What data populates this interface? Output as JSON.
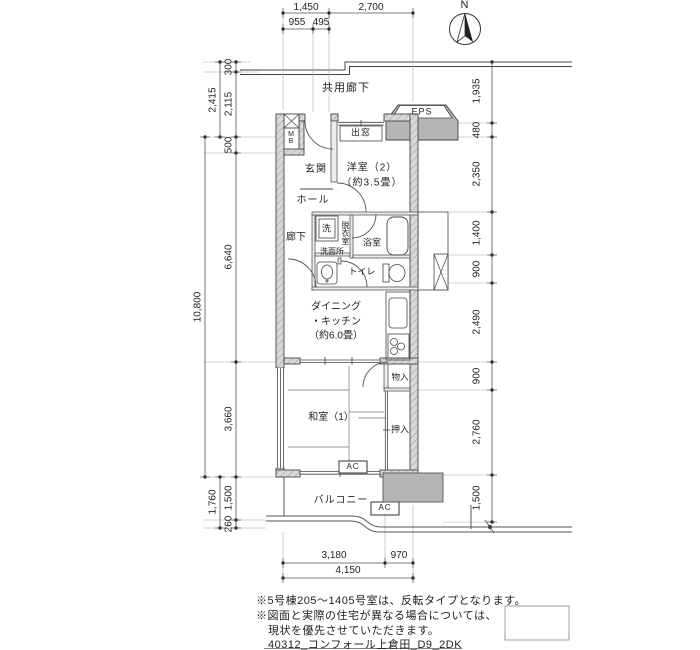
{
  "compass": {
    "north": "N"
  },
  "dimensions": {
    "top": [
      "1,450",
      "2,700"
    ],
    "top_sub": [
      "955",
      "495"
    ],
    "left_inner": [
      "300",
      "2,115",
      "500",
      "6,640",
      "3,660",
      "1,500",
      "260"
    ],
    "left_mid": [
      "2,415",
      "1,760"
    ],
    "left_outer": [
      "10,800"
    ],
    "right": [
      "1,935",
      "480",
      "2,350",
      "1,400",
      "900",
      "2,490",
      "900",
      "2,760",
      "1,500"
    ],
    "bottom": [
      "3,180",
      "970"
    ],
    "bottom_total": [
      "4,150"
    ]
  },
  "rooms": {
    "common_corridor": "共用廊下",
    "eps": "EPS",
    "bay_window": "出窓",
    "meter_box": "MB",
    "entrance": "玄関",
    "western_room2": "洋室（2）\n（約3.5畳）",
    "hall": "ホール",
    "corridor": "廊下",
    "washer": "洗",
    "dressing_room": "脱衣室",
    "bathroom": "浴室",
    "washroom": "洗面所",
    "toilet": "トイレ",
    "dining_kitchen": "ダイニング\n・キッチン\n（約6.0畳）",
    "storage": "物入",
    "japanese_room": "和室（1）",
    "closet": "押入",
    "ac": "AC",
    "balcony": "バルコニー"
  },
  "notes": {
    "line1": "※5号棟205～1405号室は、反転タイプとなります。",
    "line2": "※図面と実際の住宅が異なる場合については、",
    "line3": "現状を優先させていただきます。",
    "footer": "40312_コンフォール上倉田_D9_2DK"
  },
  "colors": {
    "wall_fill": "#d9d9d9",
    "shaded_block": "#b5b5b5",
    "line": "#333333"
  }
}
